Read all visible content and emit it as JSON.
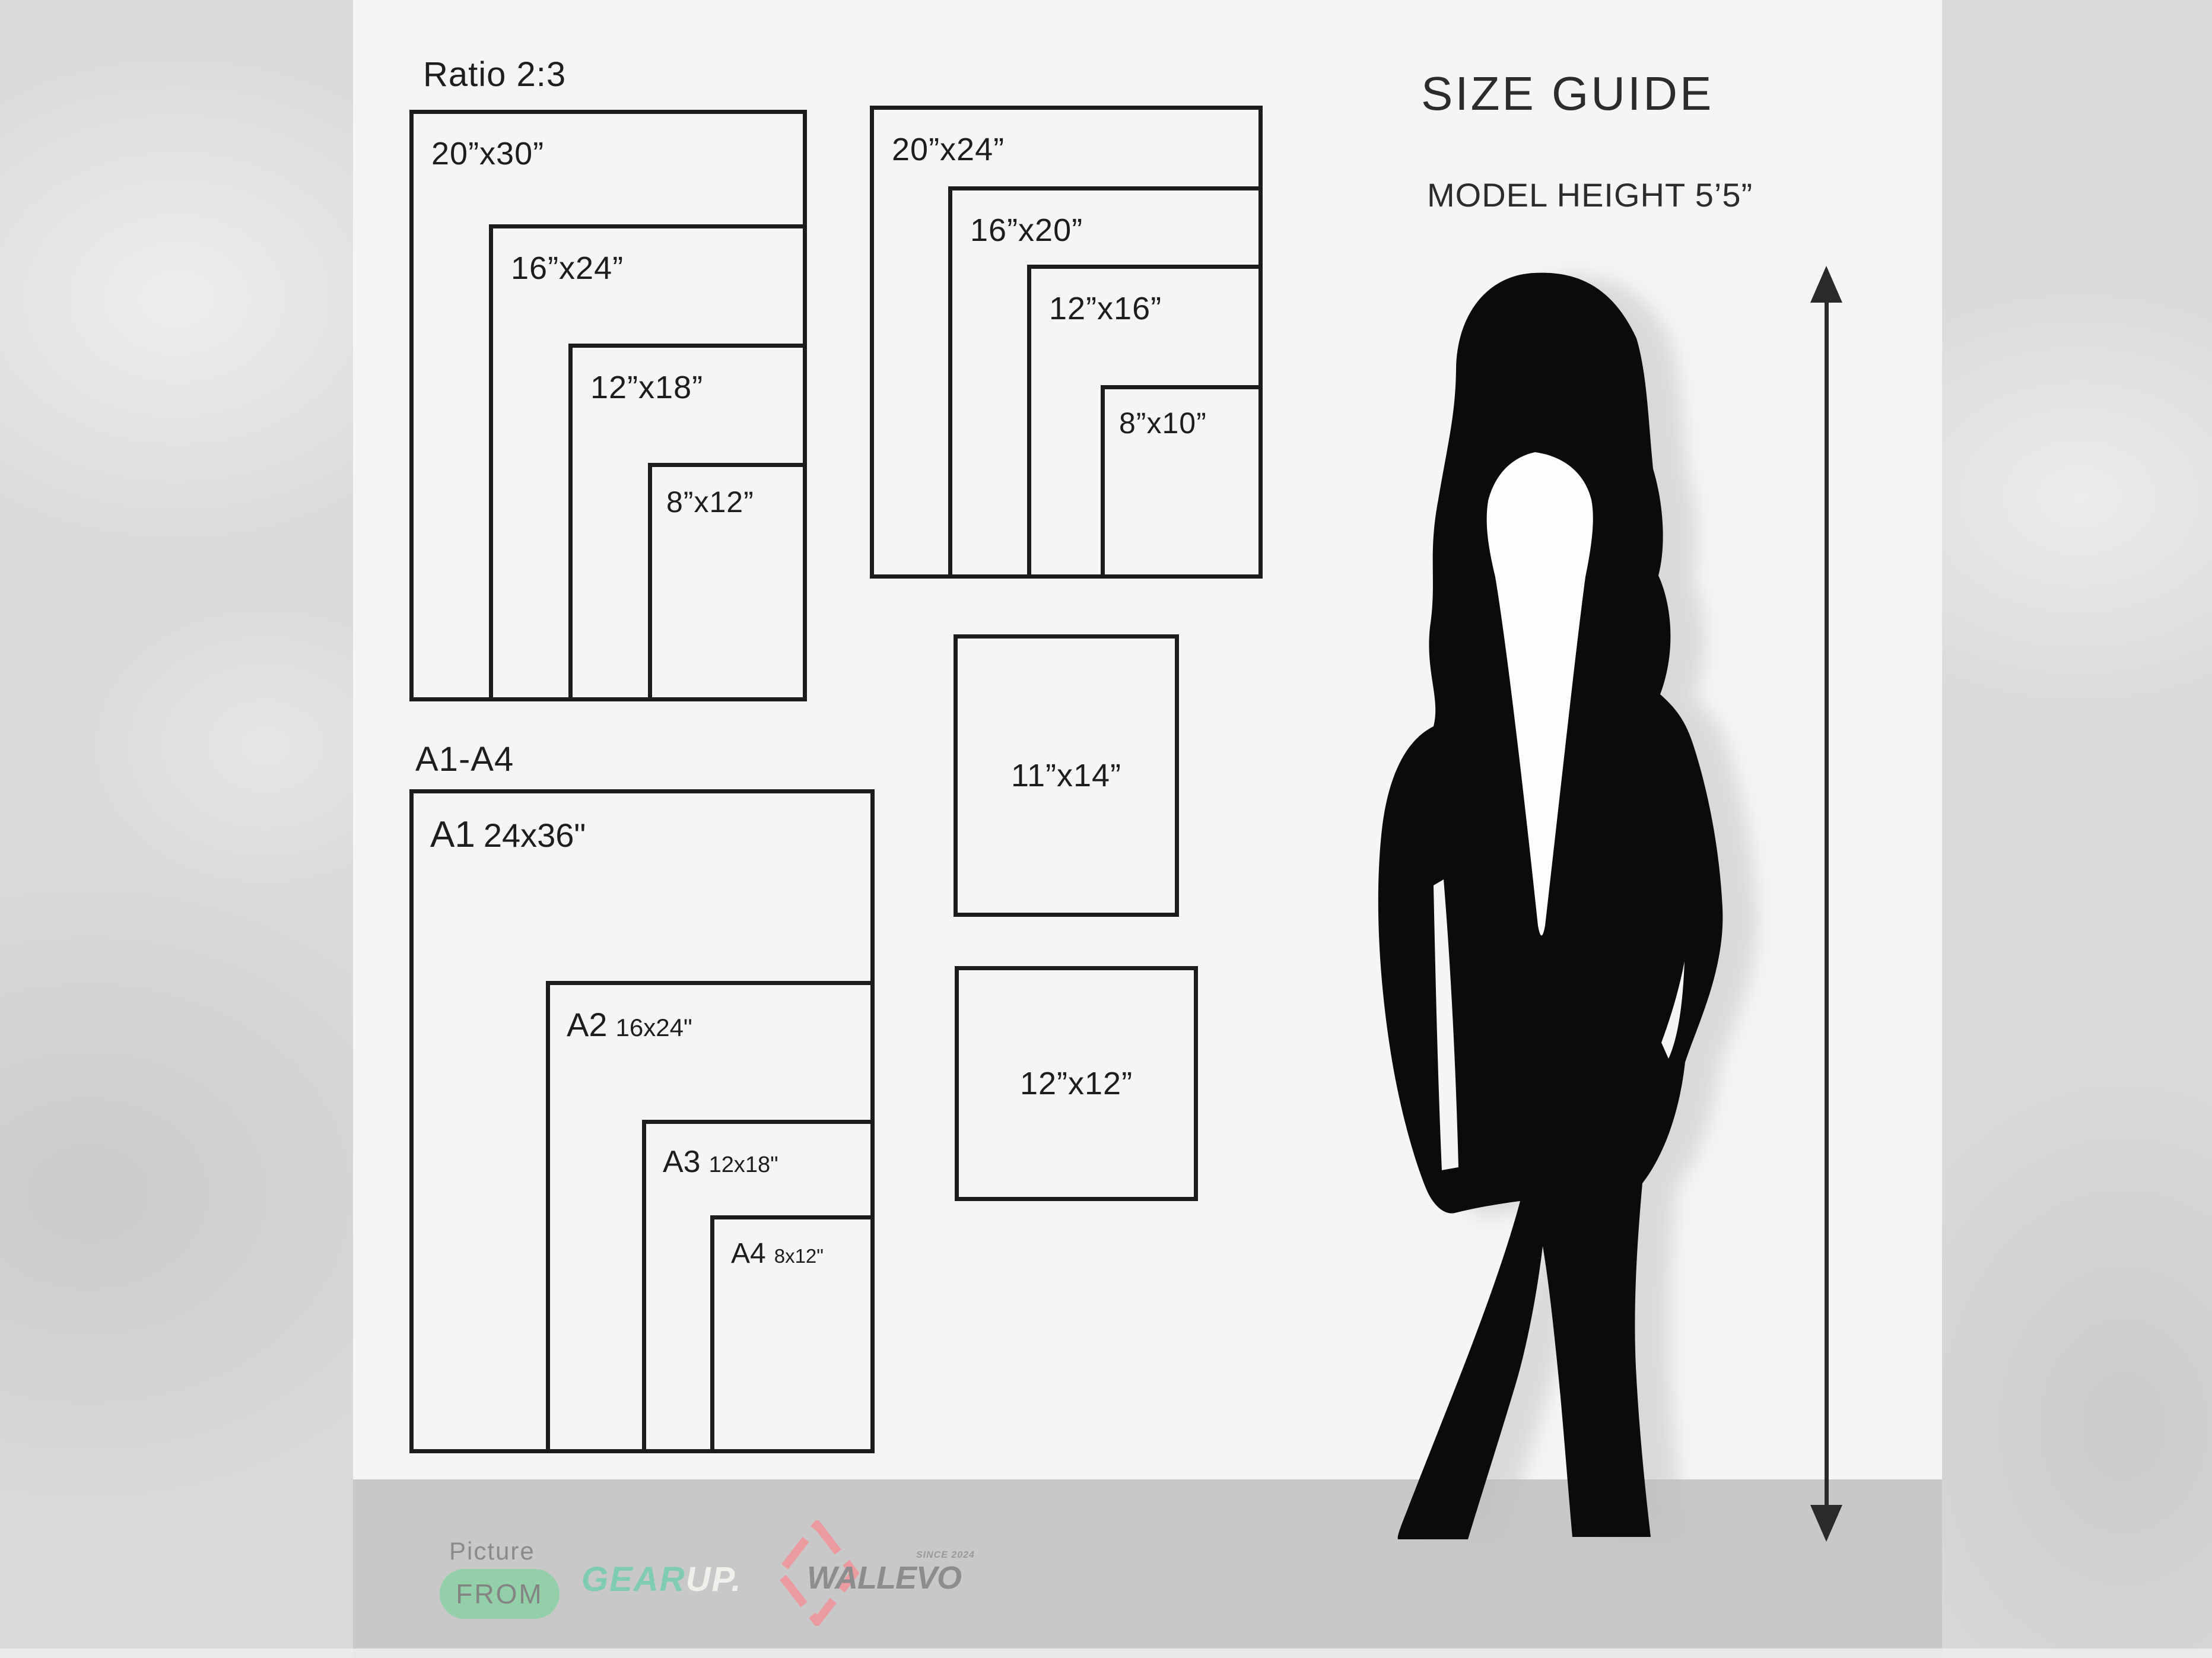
{
  "header": {
    "title": "SIZE GUIDE",
    "model_height": "MODEL HEIGHT 5’5”"
  },
  "ratio23": {
    "title": "Ratio 2:3",
    "boxes": [
      {
        "label": "20”x30”"
      },
      {
        "label": "16”x24”"
      },
      {
        "label": "12”x18”"
      },
      {
        "label": "8”x12”"
      }
    ]
  },
  "standard_set": {
    "boxes": [
      {
        "label": "20”x24”"
      },
      {
        "label": "16”x20”"
      },
      {
        "label": "12”x16”"
      },
      {
        "label": "8”x10”"
      }
    ]
  },
  "a_series": {
    "title": "A1-A4",
    "boxes": [
      {
        "name": "A1",
        "size": "24x36\""
      },
      {
        "name": "A2",
        "size": "16x24\""
      },
      {
        "name": "A3",
        "size": "12x18\""
      },
      {
        "name": "A4",
        "size": "8x12\""
      }
    ]
  },
  "single_boxes": [
    {
      "label": "11”x14”"
    },
    {
      "label": "12”x12”"
    }
  ],
  "footer": {
    "picture_label": "Picture",
    "from_label": "FROM",
    "gearup": {
      "gear": "GEAR",
      "up": "UP."
    },
    "wallevo": {
      "name": "WALLEVO",
      "since": "SINCE 2024"
    }
  },
  "icons": {
    "model_silhouette": "woman-silhouette",
    "height_arrow": "double-arrow-vertical",
    "wallevo_diamond": "diamond-outline"
  },
  "colors": {
    "mint_pill": "#93d0a9",
    "gear_teal": "#7fcbb4",
    "up_white": "#f0efec",
    "wallevo_pink": "#eb9aa0",
    "panel": "#f6f5f3",
    "strip": "#c8c8c8",
    "ink": "#1c1c1c",
    "gray_text": "#8b8b8b"
  }
}
